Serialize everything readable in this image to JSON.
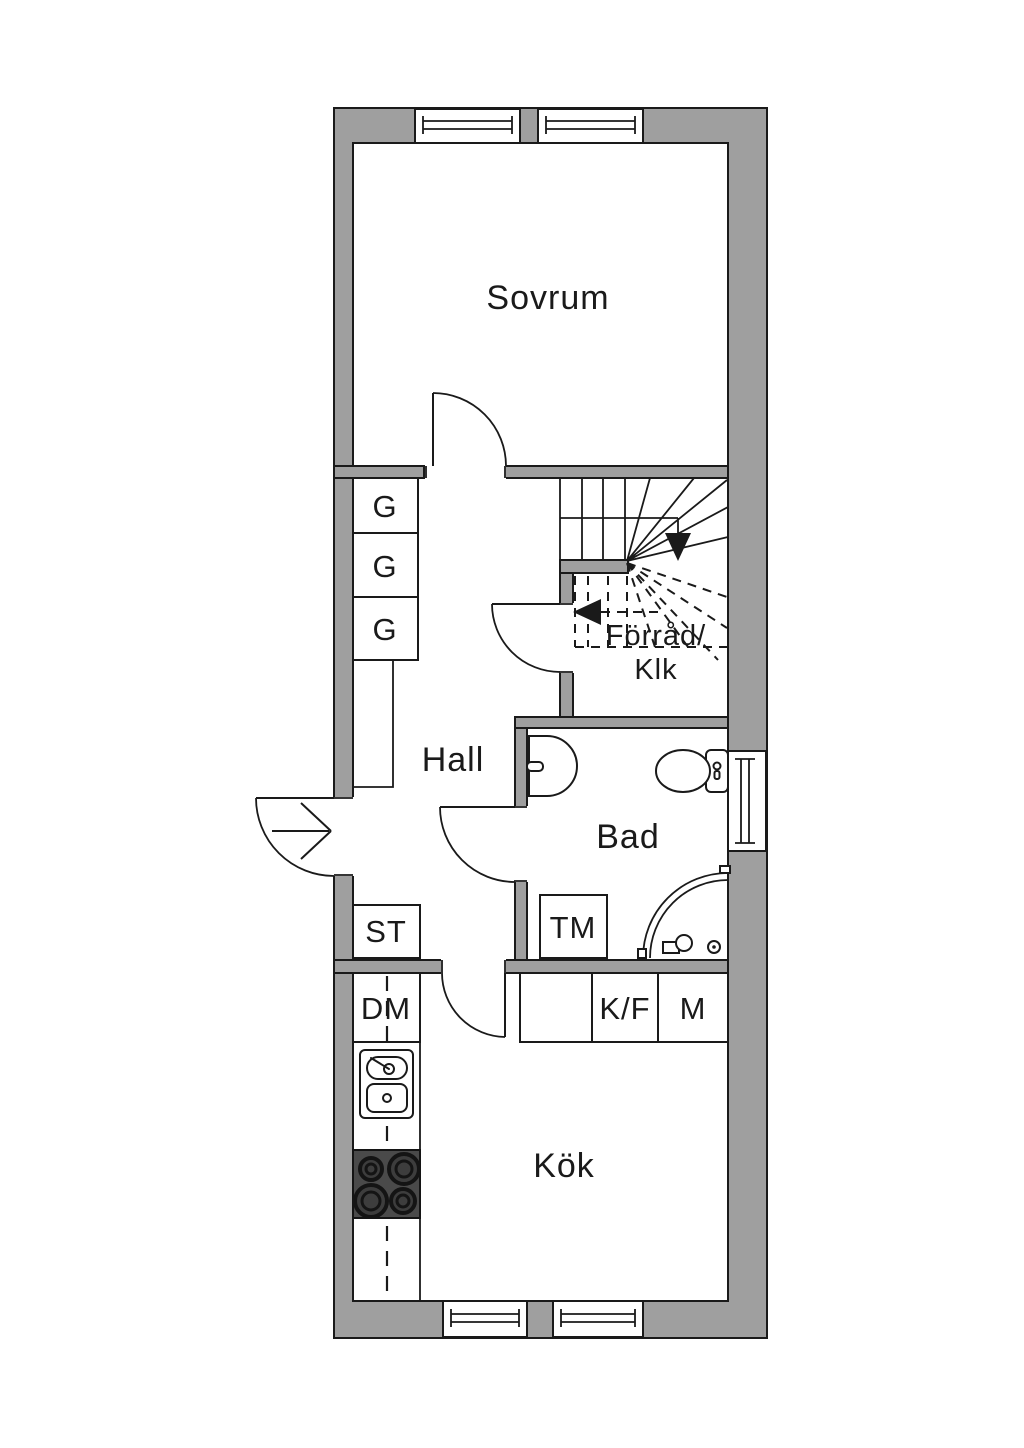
{
  "floorplan": {
    "rooms": {
      "bedroom": "Sovrum",
      "hall": "Hall",
      "bathroom": "Bad",
      "kitchen": "Kök",
      "storage_line1": "Förråd/",
      "storage_line2": "Klk"
    },
    "closets": {
      "wardrobes": [
        "G",
        "G",
        "G"
      ],
      "cleaning_closet": "ST"
    },
    "appliances": {
      "washing_machine": "TM",
      "dishwasher": "DM",
      "fridge_freezer": "K/F",
      "microwave": "M"
    },
    "icons": [
      "entry-arrow-icon",
      "door-swing-icon",
      "stairs-up-icon",
      "stairs-down-dashed-icon",
      "window-icon",
      "toilet-icon",
      "bathroom-sink-icon",
      "corner-shower-icon",
      "kitchen-sink-icon",
      "stove-icon"
    ],
    "colors": {
      "wall": "#9f9f9f",
      "line": "#1a1a1a",
      "stove": "#4a4a4a",
      "background": "#ffffff"
    }
  }
}
